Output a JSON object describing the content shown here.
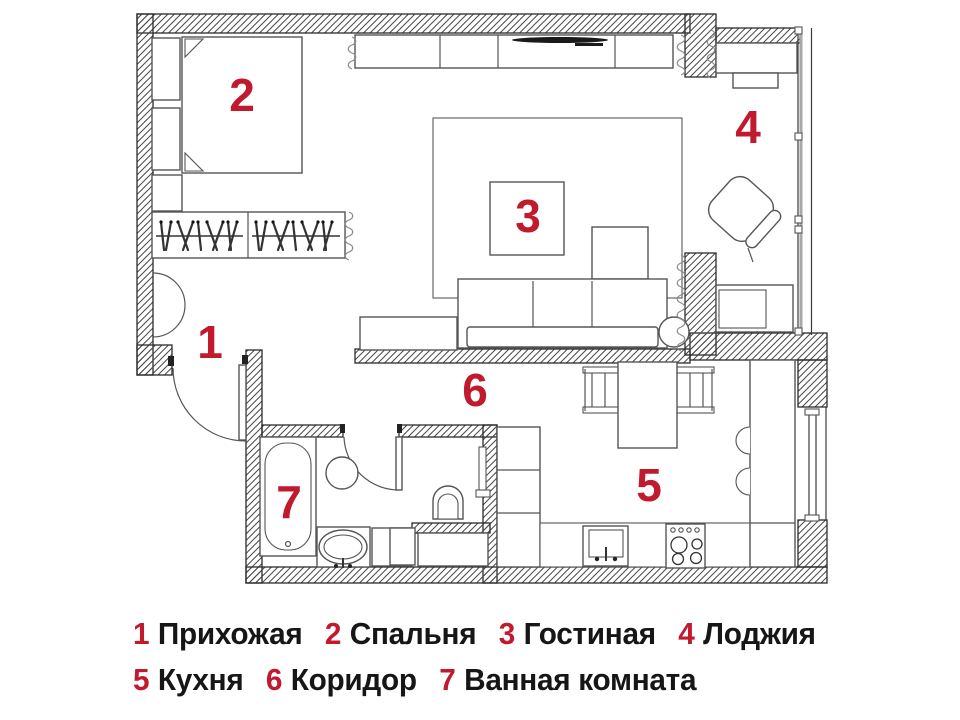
{
  "palette": {
    "accent_red": "#c1192d",
    "ink": "#161616",
    "wall_line": "#2b2b2b",
    "furniture_line": "#555555",
    "hatch_line": "#4a4a4a",
    "background": "#ffffff"
  },
  "rooms": [
    {
      "num": "1",
      "name": "Прихожая"
    },
    {
      "num": "2",
      "name": "Спальня"
    },
    {
      "num": "3",
      "name": "Гостиная"
    },
    {
      "num": "4",
      "name": "Лоджия"
    },
    {
      "num": "5",
      "name": "Кухня"
    },
    {
      "num": "6",
      "name": "Коридор"
    },
    {
      "num": "7",
      "name": "Ванная комната"
    }
  ]
}
